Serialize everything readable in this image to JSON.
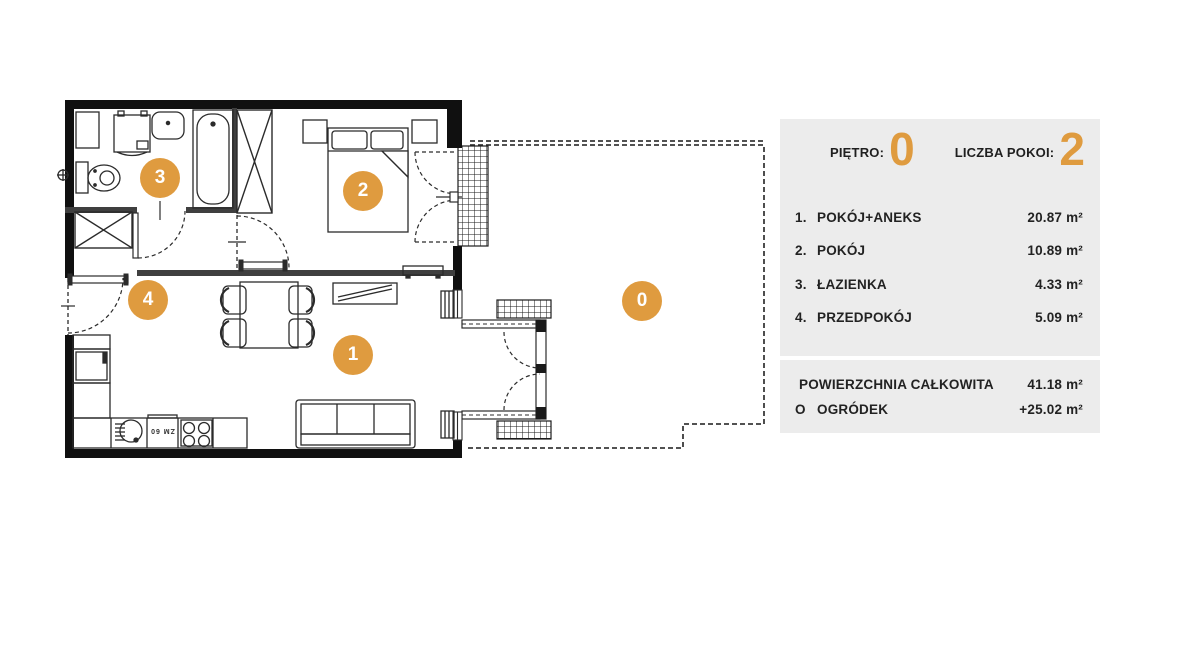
{
  "panel": {
    "floor_label": "PIĘTRO:",
    "floor_value": "0",
    "rooms_count_label": "LICZBA POKOI:",
    "rooms_count_value": "2",
    "rooms": [
      {
        "num": "1.",
        "name": "POKÓJ+ANEKS",
        "area": "20.87 m²"
      },
      {
        "num": "2.",
        "name": "POKÓJ",
        "area": "10.89 m²"
      },
      {
        "num": "3.",
        "name": "ŁAZIENKA",
        "area": "4.33 m²"
      },
      {
        "num": "4.",
        "name": "PRZEDPOKÓJ",
        "area": "5.09 m²"
      }
    ],
    "totals": [
      {
        "num": "",
        "name": "POWIERZCHNIA CAŁKOWITA",
        "area": "41.18 m²"
      },
      {
        "num": "O",
        "name": "OGRÓDEK",
        "area": "+25.02 m²"
      }
    ]
  },
  "plan": {
    "markers": [
      {
        "label": "1"
      },
      {
        "label": "2"
      },
      {
        "label": "3"
      },
      {
        "label": "4"
      },
      {
        "label": "0"
      }
    ],
    "dishwasher_label": "ZM 60",
    "colors": {
      "accent": "#DF9B3F",
      "panel_bg": "#ECECEC",
      "wall": "#101010"
    }
  }
}
